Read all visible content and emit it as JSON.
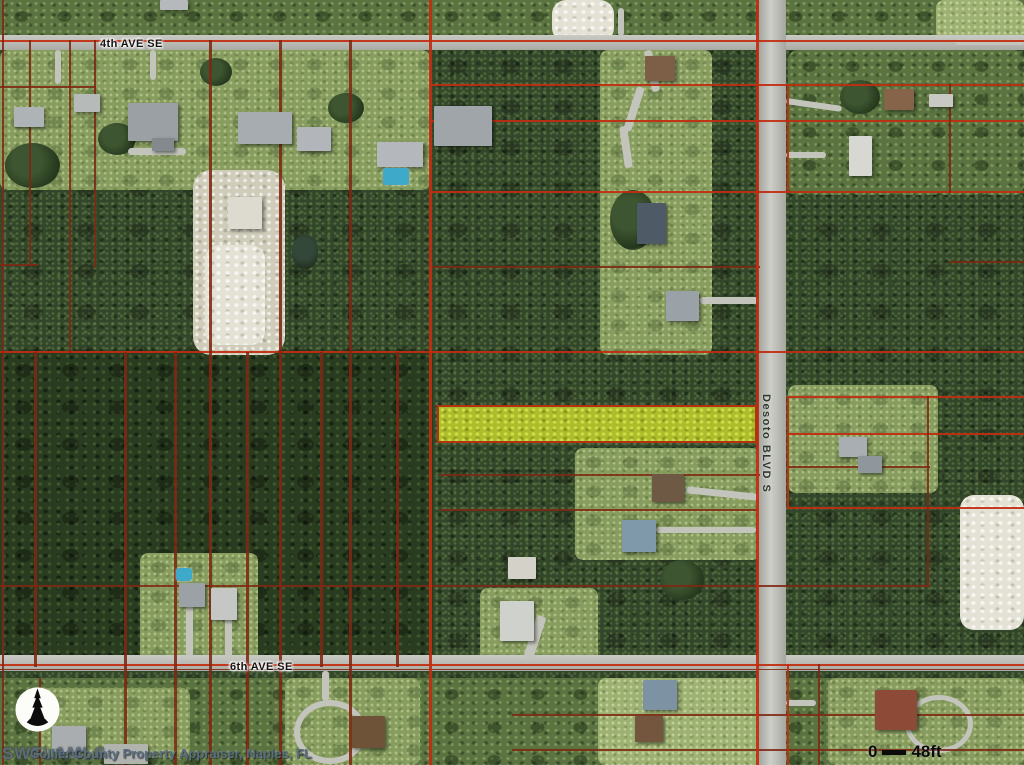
{
  "map": {
    "streets": {
      "top": "4th AVE SE",
      "bottom": "6th AVE SE",
      "right": "Desoto BLVD S"
    },
    "scale_bar": {
      "start": "0",
      "end": "48ft"
    },
    "watermark": "SWFLAMLS",
    "attribution": "Collier County Property Appraiser, Naples, FL",
    "colors": {
      "parcel_line": "#c22d10",
      "parcel_line_dark": "#7e2812",
      "highlight_fill": "#acbc2a",
      "highlight_border": "#b23312",
      "road": "#b7b9b1"
    }
  }
}
